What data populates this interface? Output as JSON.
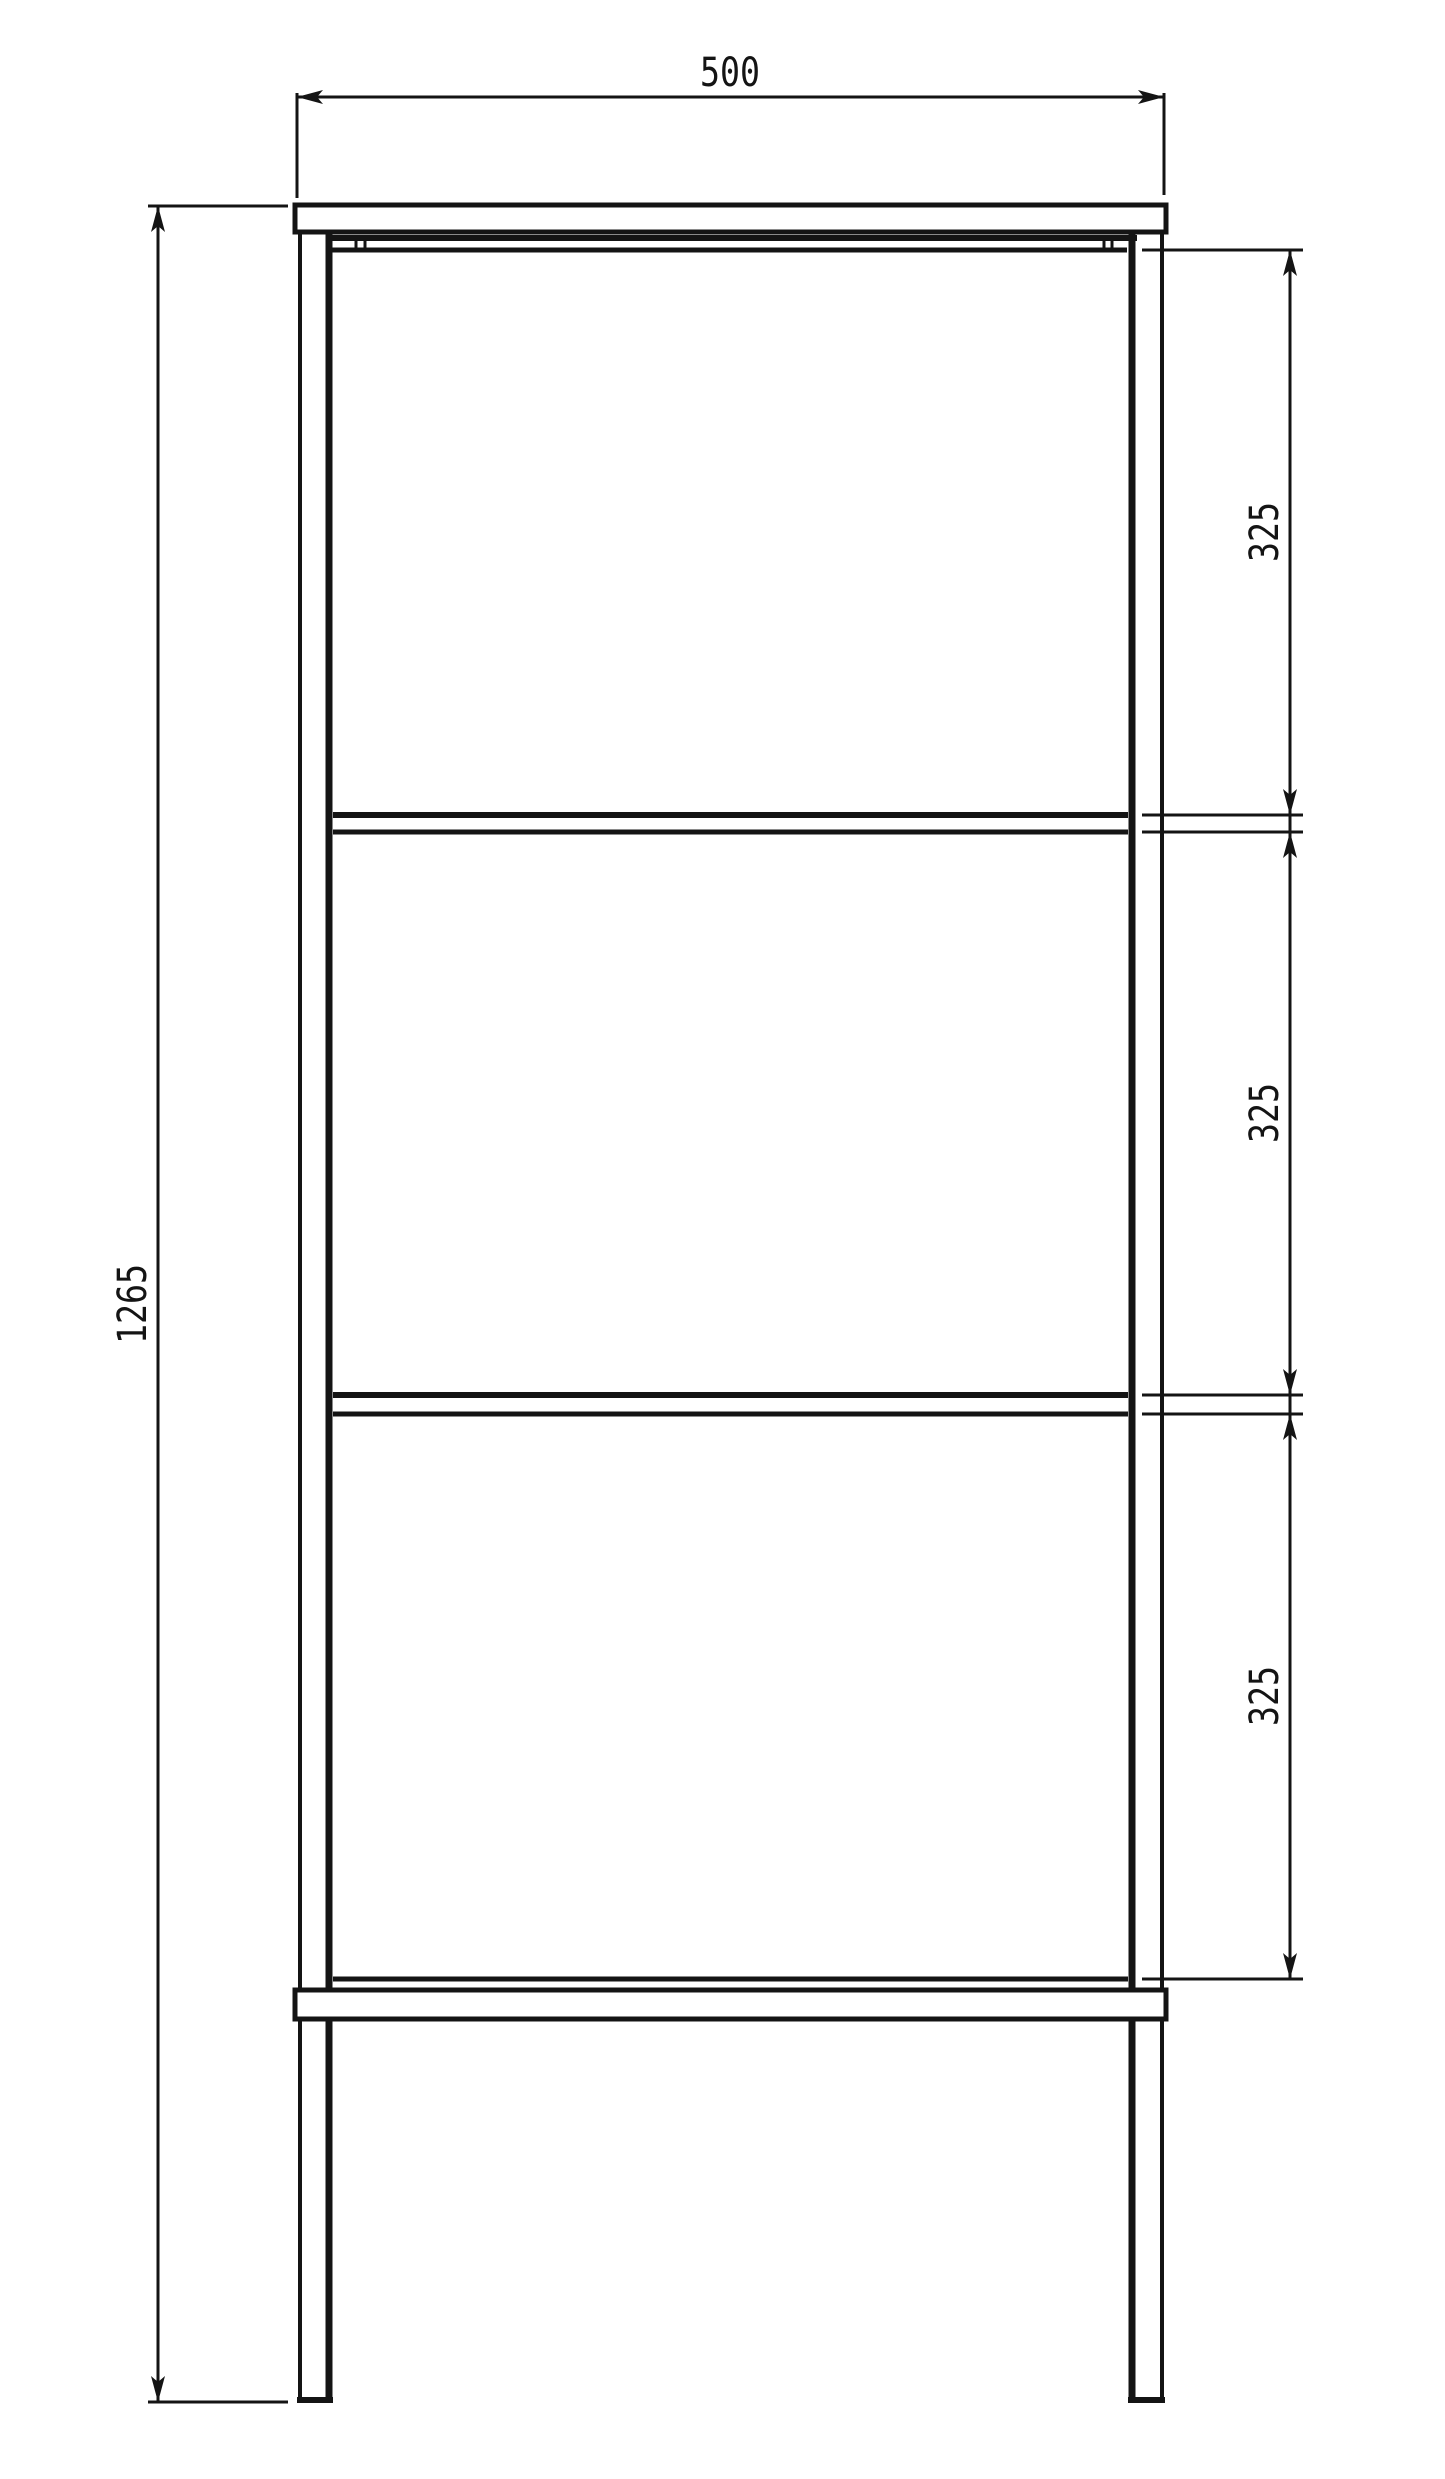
{
  "document": {
    "type": "technical-drawing",
    "view": "front-elevation",
    "subject": "metal shelf frame with top panel, two shelves and bottom stretcher",
    "units_shown": "none (plain numbers, mm implied)",
    "background_color": "#ffffff",
    "line_color": "#141414"
  },
  "dimensions": {
    "width": {
      "label": "500",
      "orientation": "horizontal",
      "position": "top"
    },
    "height": {
      "label": "1265",
      "orientation": "vertical",
      "position": "left"
    },
    "spacings": [
      {
        "label": "325",
        "orientation": "vertical",
        "position": "right",
        "segment": "top shelf opening"
      },
      {
        "label": "325",
        "orientation": "vertical",
        "position": "right",
        "segment": "middle shelf opening"
      },
      {
        "label": "325",
        "orientation": "vertical",
        "position": "right",
        "segment": "bottom shelf opening"
      }
    ]
  }
}
